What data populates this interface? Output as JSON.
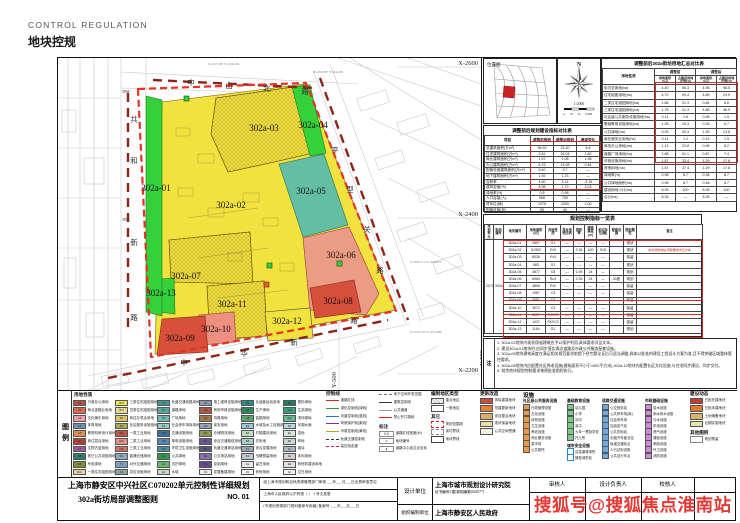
{
  "header": {
    "title_en": "CONTROL REGULATION",
    "title_zh": "地块控规"
  },
  "watermark": "搜狐号@搜狐焦点淮南站",
  "map": {
    "grid_labels": {
      "x_top": "X-2600",
      "x_mid": "X-2400",
      "x_bot": "X-2200",
      "y_right": "Y-500"
    },
    "roads": {
      "north_chars": [
        "中",
        "山",
        "北",
        "路"
      ],
      "west_chars": [
        "共",
        "和",
        "新",
        "路"
      ],
      "east_chars": [
        "平",
        "型",
        "关",
        "路"
      ],
      "south_chars": [
        "中",
        "华",
        "新",
        "路"
      ]
    },
    "width_labels": [
      "58M",
      "58M"
    ],
    "survey_points": [
      "X=257.381 Y=459.291",
      "X=256.387 Y=84.236",
      "X=295.711 Y=458.851",
      "X=256.733 Y=454.489"
    ],
    "parcels": [
      {
        "id": "302a-01",
        "color": "#35d13a"
      },
      {
        "id": "302a-02",
        "color": "#f2e23e"
      },
      {
        "id": "302a-03",
        "color": "#f2e23e"
      },
      {
        "id": "302a-04",
        "color": "#35d13a"
      },
      {
        "id": "302a-05",
        "color": "#63bfa3"
      },
      {
        "id": "302a-06",
        "color": "#ec9b85"
      },
      {
        "id": "302a-07",
        "color": "#f2e23e"
      },
      {
        "id": "302a-08",
        "color": "#d8503c"
      },
      {
        "id": "302a-09",
        "color": "#d8503c"
      },
      {
        "id": "302a-10",
        "color": "#ef8f80"
      },
      {
        "id": "302a-11",
        "color": "#f2e23e"
      },
      {
        "id": "302a-12",
        "color": "#f2e23e"
      },
      {
        "id": "302a-13",
        "color": "#35d13a"
      }
    ],
    "boundary_color": "#e43225"
  },
  "location_map": {
    "title": "位置图",
    "highlight_color": "#cc2222"
  },
  "compass": {
    "north": "N",
    "scale": "1:2000",
    "scale_ticks": [
      "0",
      "25",
      "50",
      "100M"
    ]
  },
  "table_a": {
    "title": "调整前后规划建设指标对比表",
    "widths": [
      46,
      23,
      23,
      23
    ],
    "head": [
      [
        "项目",
        "调整前规划",
        "调整后规划",
        "增减变化"
      ]
    ],
    "rows": [
      [
        "总建筑面积(万m²)",
        "96.92",
        "21.40",
        "6.6"
      ],
      [
        "住宅建筑面积(万m²)",
        "2.81",
        "16.04",
        "1.50"
      ],
      [
        "商业建筑面积(万m²)",
        "1.57",
        "1.08",
        "1.98"
      ],
      [
        "办公建筑面积(万m²)",
        "6.76",
        "14.08",
        "0.84"
      ],
      [
        "配套设施建筑面积(万m²)",
        "6.40",
        "9.7",
        "—"
      ],
      [
        "地下建筑面积(万m²)",
        "1.92",
        "1.23",
        "—"
      ],
      [
        "容积率",
        "4.90",
        "3.14",
        "-3.15"
      ],
      [
        "建筑密度(%)",
        "8.98",
        "1.70",
        "3.03"
      ],
      [
        "绿地率(%)",
        "0.5",
        "0.98",
        "—"
      ],
      [
        "人口容量(人)",
        "966",
        "750",
        "—"
      ],
      [
        "停车位(辆)",
        "1075",
        "2000",
        "2.00"
      ],
      [
        "配套设施(处)",
        "55",
        "40",
        "—"
      ]
    ]
  },
  "table_b": {
    "title": "调整前后302a街坊用地汇总对比表",
    "corner": "用地性质",
    "group_pre": "调整前",
    "group_post": "调整后",
    "sub1": "用地面积(ha)",
    "sub2": "占建设用地比例(%)",
    "rows": [
      [
        "街坊总用地(ha)",
        "4.40",
        "98.3",
        "4.95",
        "98.5"
      ],
      [
        "住宅组团用地(ha)",
        "4.70",
        "93.4",
        "4.85",
        "24.9"
      ],
      [
        "二类住宅组团用地(ha)",
        "1.88",
        "31.3",
        "0.84",
        "8.6"
      ],
      [
        "三类住宅组团用地(ha)",
        "1.75",
        "31.3",
        "4.88",
        "46.5"
      ],
      [
        "社区级公共服务设施用地(ha)",
        "0.11",
        "1.8",
        "0.98",
        "1.9"
      ],
      [
        "基础教育设施用地(ha)",
        "1.35",
        "15.3",
        "0.35",
        "6.7"
      ],
      [
        "公共绿地(ha)",
        "0.35",
        "30.3",
        "1.35",
        "13.8"
      ],
      [
        "商业服务业用地(ha)",
        "0.11",
        "1.2",
        "0.15",
        "1.5"
      ],
      [
        "商务办公用地(ha)",
        "1.13",
        "23.8",
        "0.98",
        "8.2"
      ],
      [
        "道路广场用地(ha)",
        "1.88",
        "51.1",
        "0.87",
        "7.4"
      ],
      [
        "市政设施用地(ha)",
        "1.87",
        "33.4",
        "1.29",
        "17.6"
      ],
      [
        "其他用地(ha)",
        "1.87",
        "37.4",
        "1.29",
        "17.8"
      ],
      [
        "绿地率(%)",
        "0.98",
        "8.7",
        "0.38",
        "8.7"
      ],
      [
        "公共绿地面积(ha)",
        "0.98",
        "8.7",
        "0.48",
        "8.7"
      ],
      [
        "建设用地小计(ha)",
        "8.35",
        "100",
        "8.35",
        "100"
      ],
      [
        "合计(ha)",
        "8.35",
        "—",
        "8.35",
        "—"
      ]
    ]
  },
  "parcel_table": {
    "title": "规划控制指标一览表",
    "unit": "C0702",
    "block": "302a",
    "head": [
      "规划单元",
      "街坊编号",
      "地块编号",
      "用地面积(㎡)",
      "用地性质",
      "混合用地比例",
      "容积率",
      "建筑高度(m)",
      "机动车位(辆)",
      "配套设施",
      "规划属性",
      "备注"
    ],
    "widths": [
      9,
      10,
      23,
      19,
      15,
      13,
      11,
      12,
      13,
      14,
      13,
      66
    ],
    "rows": [
      [
        "302a-01",
        "2897",
        "G1",
        "—",
        "—",
        "—",
        "—",
        "",
        "现状",
        ""
      ],
      [
        "302a-02",
        "51352",
        "Rr3",
        "—",
        "2.35",
        "100",
        "518",
        "",
        "现状",
        "本次调整地块,调整要求详见文本"
      ],
      [
        "302a-03",
        "8026",
        "Rr3",
        "—",
        "—",
        "—",
        "—",
        "",
        "保留",
        ""
      ],
      [
        "302a-04",
        "583",
        "G1",
        "—",
        "—",
        "—",
        "—",
        "",
        "现状",
        ""
      ],
      [
        "302a-05",
        "4877",
        "C8",
        "—",
        "1.95",
        "24",
        "—",
        "",
        "规划",
        ""
      ],
      [
        "302a-06",
        "6964",
        "Rc3",
        "—",
        "2.35",
        "24",
        "—",
        "40座",
        "规划",
        ""
      ],
      [
        "302a-07",
        "4806",
        "Rr2",
        "—",
        "—",
        "—",
        "—",
        "",
        "保留",
        ""
      ],
      [
        "302a-08",
        "1987",
        "C3",
        "—",
        "—",
        "—",
        "—",
        "",
        "保留",
        ""
      ],
      [
        "302a-09",
        "2581",
        "C3",
        "—",
        "—",
        "—",
        "—",
        "",
        "保留",
        ""
      ],
      [
        "302a-10",
        "3072",
        "C3",
        "—",
        "—",
        "—",
        "—",
        "",
        "保留",
        ""
      ],
      [
        "302a-11",
        "6007",
        "Rr2/C3",
        "—",
        "—",
        "—",
        "—",
        "",
        "保留",
        ""
      ],
      [
        "302a-12",
        "1437",
        "Rr2/C3",
        "—",
        "—",
        "—",
        "—",
        "",
        "保留",
        ""
      ],
      [
        "302a-13",
        "1184",
        "G1",
        "—",
        "—",
        "—",
        "—",
        "",
        "规划",
        ""
      ]
    ],
    "note_label": "注",
    "notes": [
      "1. 302a-02地块内现状保留建筑应予以保护利用,具体要求详见文本。",
      "2. 建设302a-03地块时,应同步落实周边道路及市政公共服务配套设施。",
      "3. 302a-05地块建筑高度在满足相关规范要求前提下经专题论证后可适当调整,具体以批准的建设工程设计方案为准,且不得突破区域整体管控要求。",
      "4. 302a-06地块内应配置社区养老设施(建筑面积不小于1000平方米),302a-12地块内配置社区文化设施,与住宅同步建设、同步交付。",
      "5. 其余地块规划控制要求按原批准图则执行。"
    ]
  },
  "legend": {
    "side_label": "图例",
    "landuse_header": "用地性质",
    "landuse": [
      {
        "code": "C1",
        "c": "#b0564a",
        "t": "行政办公用地"
      },
      {
        "code": "C2",
        "c": "#dd6a55",
        "t": "商业金融业用地"
      },
      {
        "code": "C3",
        "c": "#eba0ab",
        "t": "文化娱乐用地"
      },
      {
        "code": "C4",
        "c": "#7292b5",
        "t": "体育用地"
      },
      {
        "code": "C6",
        "c": "#de9050",
        "t": "教育科研设计用地"
      },
      {
        "code": "Cr",
        "c": "#b4403a",
        "t": "商住混合用地"
      },
      {
        "code": "C7",
        "c": "#9a5f9e",
        "t": "文物古迹用地"
      },
      {
        "code": "C8",
        "c": "#2f7f6f",
        "t": "其它公共设施用地"
      },
      {
        "code": "G3",
        "c": "#7d8f3e",
        "t": "专用绿地"
      },
      {
        "code": "Rr1",
        "c": "#e6d3a2",
        "t": "一类住宅组团用地"
      },
      {
        "code": "Rr3",
        "c": "#f2e84c",
        "t": "三类住宅组团用地"
      },
      {
        "code": "Rr4",
        "c": "#e9dc92",
        "t": "四类住宅组团用地"
      },
      {
        "code": "Rc",
        "c": "#d9c46e",
        "t": "商住办混合用地"
      },
      {
        "code": "Rs",
        "c": "#a9ad55",
        "t": "社区服务设施用地"
      },
      {
        "code": "M1",
        "c": "#c2574a",
        "t": "一类工业用地"
      },
      {
        "code": "M2",
        "c": "#e59287",
        "t": "二类工业用地"
      },
      {
        "code": "M3",
        "c": "#d3766a",
        "t": "三类工业用地"
      },
      {
        "code": "W1",
        "c": "#92aabf",
        "t": "普通仓储用地"
      },
      {
        "code": "T1",
        "c": "#7f9fc0",
        "t": "对外交通用地"
      },
      {
        "code": "U1",
        "c": "#8fa9a0",
        "t": "供应设施用地"
      },
      {
        "code": "Tm",
        "c": "#3f9a95",
        "t": "轨道交通线路用地"
      },
      {
        "code": "S1",
        "c": "#58a8a0",
        "t": "道路用地"
      },
      {
        "code": "S2",
        "c": "#73b8ae",
        "t": "广场用地"
      },
      {
        "code": "S3",
        "c": "#99cdb8",
        "t": "社会停车场库用地"
      },
      {
        "code": "U2",
        "c": "#3a6f9e",
        "t": "交通设施用地"
      },
      {
        "code": "U3",
        "c": "#5588b8",
        "t": "邮电设施用地"
      },
      {
        "code": "U4",
        "c": "#4a92a0",
        "t": "环境卫生设施用地"
      },
      {
        "code": "G1",
        "c": "#2f9a4e",
        "t": "公共绿地"
      },
      {
        "code": "G2",
        "c": "#69b56f",
        "t": "防护绿地"
      },
      {
        "code": "E1",
        "c": "#cdd8cd",
        "t": "水域"
      },
      {
        "code": "U5",
        "c": "#8c9cb2",
        "t": "施工维修设施用地"
      },
      {
        "code": "U9",
        "c": "#b05848",
        "t": "其他市政设施用地"
      },
      {
        "code": "D1",
        "c": "#a5794f",
        "t": "特殊用地"
      },
      {
        "code": "D3",
        "c": "#98a3b8",
        "t": "保安用地"
      },
      {
        "code": "Wx",
        "c": "#909a55",
        "t": "仓储物流用地"
      },
      {
        "code": "Tx",
        "c": "#6a5690",
        "t": "综合交通枢纽用地"
      },
      {
        "code": "Sa",
        "c": "#565a7c",
        "t": "轨道交通场站用地"
      },
      {
        "code": "Sb",
        "c": "#8f6fae",
        "t": "公交场站用地"
      },
      {
        "code": "X1",
        "c": "#6a4a8f",
        "t": "控制用地"
      },
      {
        "code": "X2",
        "c": "#eeeeee",
        "t": "发展备建用地"
      },
      {
        "code": "Tb",
        "c": "#2e8b8b",
        "t": "长途客运站用地"
      },
      {
        "code": "G4",
        "c": "#2e8b57",
        "t": "生产绿地"
      },
      {
        "code": "G5",
        "c": "#58a86b",
        "t": "苗圃用地"
      },
      {
        "code": "E2",
        "c": "#9cc8e0",
        "t": "水域及水工设施用地"
      },
      {
        "code": "E6",
        "c": "#c2dcc2",
        "t": "村镇建设用地"
      },
      {
        "code": "E8",
        "c": "#a8cfc4",
        "t": "农用地"
      },
      {
        "code": "F1",
        "c": "#9aa8b8",
        "t": "综合发展用地"
      },
      {
        "code": "F2",
        "c": "#c0c8d0",
        "t": "战略预留用地"
      },
      {
        "code": "Fa",
        "c": "#e8e8e8",
        "t": "留白用地"
      },
      {
        "code": "Fb",
        "c": "#f5f5f5",
        "t": "其他用地"
      },
      {
        "code": "Gc",
        "c": "#1f7f6a",
        "t": "楔形绿地"
      },
      {
        "code": "Gd",
        "c": "#3a9f7f",
        "t": "生态绿地"
      },
      {
        "code": "Ge",
        "c": "#66b892",
        "t": "滨河绿地"
      },
      {
        "code": "Ef",
        "c": "#b8d8e8",
        "t": "河湖水面"
      },
      {
        "code": "Eg",
        "c": "#d8e8d8",
        "t": "湿地"
      },
      {
        "code": "Eh",
        "c": "#c8d8c8",
        "t": "林地"
      },
      {
        "code": "Ei",
        "c": "#a8b8c8",
        "t": "滩涂"
      },
      {
        "code": "Ej",
        "c": "#d0d0d0",
        "t": "未利用地"
      },
      {
        "code": "Ek",
        "c": "#e0e0e0",
        "t": "其他非建设用地"
      },
      {
        "code": "El",
        "c": "#f0f0f0",
        "t": "空白用地"
      }
    ],
    "control_lines": {
      "header": "控制线",
      "items": [
        {
          "ln": "#e02020",
          "t": "道路红线"
        },
        {
          "ln": "#2a9a3a",
          "t": "绿化控制线(绿线)"
        },
        {
          "ln": "#2a6ae0",
          "t": "河道控制线(蓝线)"
        },
        {
          "ln": "#8a2aa0",
          "t": "风貌保护线(紫线)"
        },
        {
          "ln": "#c8a020",
          "t": "市政控制线(黄线)"
        },
        {
          "ln": "#333333",
          "dash": true,
          "t": "轨道交通控制线"
        },
        {
          "ln": "#e02020",
          "dash": true,
          "t": "高压线走廊"
        }
      ]
    },
    "misc_lines": {
      "items": [
        {
          "ln": "#777777",
          "dash": true,
          "t": "地下空间开发范围"
        },
        {
          "ln": "#333333",
          "t": "建筑控制线"
        },
        {
          "ln": "#999999",
          "t": "公共通道"
        },
        {
          "ln": "#e02020",
          "t": "禁止开口路段"
        }
      ],
      "anno_header": "标注",
      "annos": [
        {
          "sym": "X-X",
          "t": "道路红线宽度(M)"
        },
        {
          "sym": "▭",
          "t": "地块编号"
        },
        {
          "sym": "●",
          "t": "道路中心线交点坐标"
        }
      ]
    },
    "district": {
      "header": "编制地区类型",
      "items": [
        {
          "hatch": true,
          "t": "重点地区"
        },
        {
          "hatch": false,
          "t": "一般地区"
        }
      ],
      "other_header": "其它",
      "others": [
        {
          "c": "#ffffff",
          "border": "#e02020",
          "dashed": true,
          "t": "规划范围线"
        },
        {
          "c": "#ffffff",
          "border": "#888888",
          "dashed": true,
          "t": "街坊界线"
        },
        {
          "c": "#ffffff",
          "border": "#444444",
          "dashed": false,
          "t": "地块界线"
        }
      ]
    },
    "renewal": {
      "header": "更新改造",
      "items": [
        {
          "c": "#cf4a3a",
          "t": "拆除重建地块"
        },
        {
          "c": "#e0823c",
          "t": "改建更新地块"
        },
        {
          "c": "#d8b06a",
          "t": "综合整治地块"
        },
        {
          "c": "#eae2a0",
          "t": "现状保留地块"
        },
        {
          "c": "#f2f2da",
          "t": "公共空间贯通"
        }
      ]
    },
    "facility_header": "设施",
    "community": {
      "header": "社区级公共服务设施",
      "color": "#e89a4a",
      "items": [
        "行政管理设施",
        "文化设施",
        "体育设施",
        "卫生设施",
        "养老设施",
        "商业服务设施",
        "菜市场",
        "公共厕所"
      ]
    },
    "education": {
      "header": "基础教育设施",
      "color": "#7cc98a",
      "items": [
        "幼儿园",
        "小学",
        "初中",
        "高中",
        "九年一贯制学校",
        "托儿所"
      ]
    },
    "safety": {
      "header": "城市安全设施",
      "color": "#ffffff",
      "items": [
        "应急避难场所",
        "微型消防站"
      ]
    },
    "transport": {
      "header": "道路交通设施",
      "color": "#6fa8dc",
      "items": [
        "公交首末站",
        "公共停车场(库)",
        "社会停车场",
        "加油加气站",
        "公共充电站",
        "出租汽车营业站",
        "轨道交通站点",
        "人行过街设施",
        "公共自行车点"
      ]
    },
    "municipal": {
      "header": "市政基础设施",
      "color": "#cf8ad8",
      "items": [
        "给水设施",
        "雨水排水设施",
        "污水设施",
        "供电设施",
        "燃气设施",
        "通信设施",
        "邮政设施",
        "环卫设施",
        "消防设施"
      ]
    },
    "dynamics": {
      "header": "建设动态",
      "items": [
        {
          "c": "#cc3b2f",
          "t": "已批在建地块"
        },
        {
          "c": "#e07b30",
          "t": "已批未建地块"
        },
        {
          "c": "#d9b36a",
          "t": "土地储备地块"
        },
        {
          "c": "#dfe8a8",
          "t": "近期实施地块"
        }
      ],
      "other_header": "其他图例",
      "others": [
        {
          "c": "#ffffff",
          "t": "规划预留"
        }
      ]
    }
  },
  "title_block": {
    "main_title": "上海市静安区中兴社区C070202单元控制性详细规划",
    "sub_title": "302a街坊局部调整图则",
    "sheet_no": "NO. 01",
    "approval_lines": [
      "经上海市规划和自然资源管理部门审查  ___年___月___日出具审查意见",
      "上海市人民政府以沪府规〔  〕 1 号文批复",
      "(市规划资源部门规划备案专用章)  备案号: ___年___月___日"
    ],
    "design_unit_label": "设计单位",
    "design_unit": "上海市城市规划设计研究院",
    "cert_no": "证书编号:[建]城规编第(041077)",
    "org_unit_label": "组织编制单位",
    "org_unit": "上海市静安区人民政府",
    "reviewer_label": "审核人",
    "designer_label": "设计负责人",
    "checker_label": "校核人"
  }
}
